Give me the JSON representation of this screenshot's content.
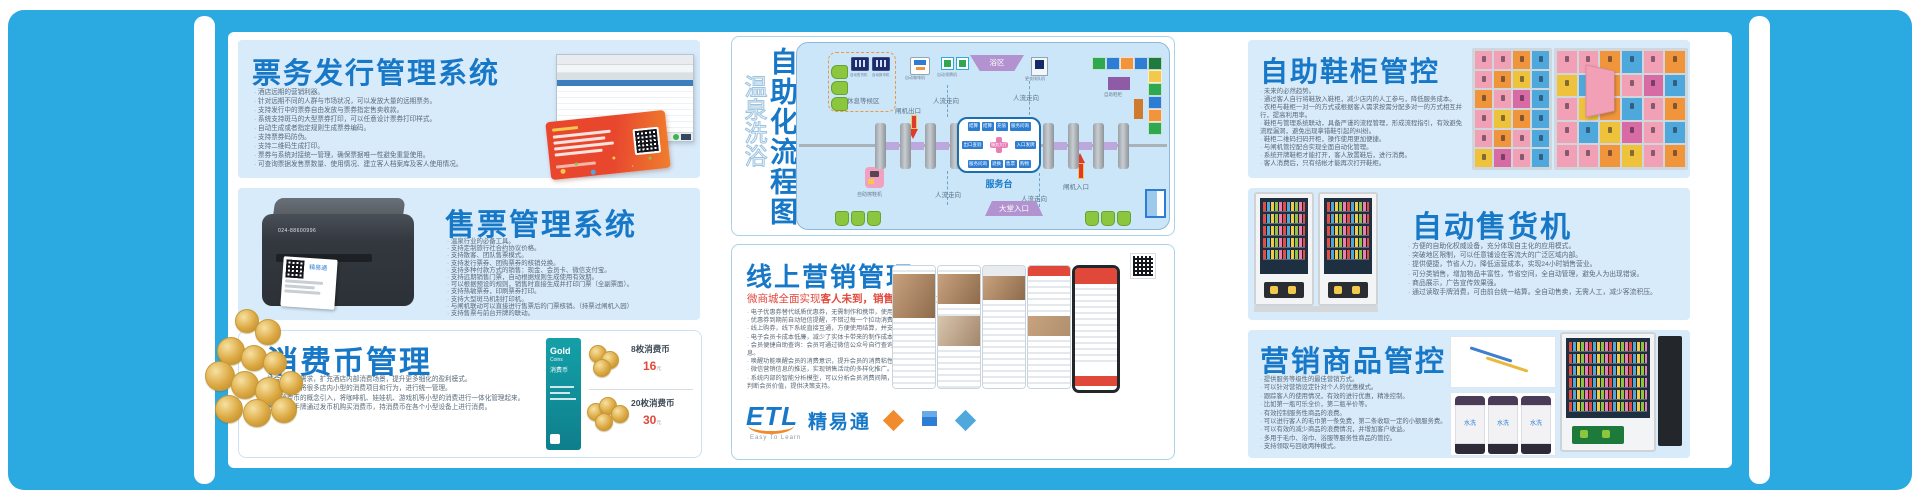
{
  "colors": {
    "accent_blue": "#2BA9E1",
    "title_blue": "#1878C8",
    "panel_blue": "#D8EBFA",
    "alert_red": "#E2483C"
  },
  "panels": {
    "ticketing": {
      "title": "票务发行管理系统",
      "bullets": [
        "酒店远期的营销利器。",
        "针对远期不同的人群与市场状况，可以发放大量的远期票务。",
        "支持发行中的票券自由发放与票券指定售卖收款。",
        "系统支持斑马的大型票券打印，可以任意设计票券打印样式。",
        "自动生成或者指定规则生成票券编码。",
        "支持票券码防伪。",
        "支持二维码生成打印。",
        "票券与系统对接统一管理，确保票据唯一性避免重复使用。",
        "可查询票据发售票数量、使用情况、建立客人档案库及客人使用情况。"
      ]
    },
    "ticket_sales": {
      "title": "售票管理系统",
      "printer_label": "024-88600996",
      "ticket_brand": "精易通",
      "bullets": [
        "温泉行业的必备工具。",
        "支持定制旅行社合约协议价格。",
        "支持散客、团队售票模式。",
        "支持发行票券、团购票券的核销兑换。",
        "支持多种付款方式的销售：现金、会员卡、微信支付宝。",
        "支持远期销售门票，自动根据规则生成使用有效期。",
        "可以根据预设的规则，销售时直接生成并打印门票（全副票面）。",
        "支持热敏票券，印刷票券打印。",
        "支持大型斑马机制打印机。",
        "与闸机联动可以直接进行售票后的门票核销。（持票过闸机入园）",
        "支持售票与前台开牌的联动。"
      ]
    },
    "coins": {
      "title": "消费币管理",
      "bullets": [
        "结合消费的需求，扩充酒店内部消费场景，提升更多细化的盈利模式。",
        "利用消费币将很多店内小型的消费项目和行为，进行统一管理。",
        "利用消费币的概念引入，将咖啡机、娃娃机、游戏机等小型的消费进行一体化管理起来。",
        "客人利用手牌通过发币机购买消费币，持消费币在各个小型设备上进行消费。"
      ],
      "card": {
        "brand": "Gold",
        "brand2": "Coins",
        "subtitle": "消费币"
      },
      "items": [
        {
          "label": "8枚消费币",
          "price": "16",
          "unit": "元"
        },
        {
          "label": "20枚消费币",
          "price": "30",
          "unit": "元"
        }
      ]
    },
    "flow": {
      "title_main": "自助化流程图",
      "title_sub": "温泉洗浴",
      "rest_area": "休息等候区",
      "machine_labels": [
        "自动售货机",
        "自动换币机",
        "自动咖啡机"
      ],
      "gate_exit": "闸机出口",
      "gate_entry": "闸机入口",
      "people_flow": "人流走向",
      "shoe_polisher": "自助擦鞋机",
      "bath_area": "浴区",
      "claim_machine": "自动领牌机",
      "queue_machine": "更衣排队机",
      "shoe_cabinet": "自助鞋柜",
      "lobby_entrance": "大堂入口",
      "service_desk": "服务台",
      "service_box": {
        "top": [
          "结算",
          "结算",
          "充值",
          "服务问询"
        ],
        "left": "出口查验",
        "center": "服务大厅",
        "right": "入口发牌",
        "bottom": [
          "服务问询",
          "退换",
          "售票",
          "购物"
        ]
      }
    },
    "online": {
      "title": "线上营销管理",
      "subtitle_lead": "微商城全面实现",
      "subtitle_strong": "客人未到，销售先行",
      "subtitle_tail": "的理念",
      "bullets": [
        "电子优惠券替代纸质优惠券，无需制作和携带，使用方便。",
        "优惠券到期前自动短信提醒，不错过每一个拉动消费的机会。",
        "线上购券，线下系统直接互通，方便使用结算，并支持核销。",
        "电子会员卡成本低廉，减少了实体卡带来的制作成本。",
        "会员便捷自助查询：会员可通过微信公众号自行查询相关信息。",
        "唤醒功能唤醒会员的消费意识，提升会员的消费粘性。",
        "微信营销信息的推送，实现销售活动的多样化推广。",
        "系统内部的智能分析模型，可以分析会员消费间隔，帮您精准判断会员价值，提供决策支持。"
      ],
      "logo": {
        "etl": "ETL",
        "brand": "精易通",
        "tagline": "Easy To Learn"
      }
    },
    "lockers": {
      "title": "自助鞋柜管控",
      "bullets": [
        "未来的必然趋势。",
        "通过客人自行将鞋放入鞋柜，减少店内的人工参与，降低服务成本。",
        "衣柜与鞋柜一对一的方式或根据客人需求按需分配多对一的方式相互并行，提高利用率。",
        "鞋柜与管理系统联动，具备严谨的流程管理，形成流程指引，有效避免流程漏洞，避免出现拿错鞋引起的纠纷。",
        "鞋柜二维码扫码开柜，操作使用更加便捷。",
        "与闸机管控配合实现全面自动化管理。",
        "系统开牌鞋柜才能打开，客人放置鞋后，进行消费。",
        "客人消费后，只有结帐才能再次打开鞋柜。"
      ]
    },
    "vending": {
      "title": "自动售货机",
      "bullets": [
        "方便的自助化权威设备，充分体现自主化的应用模式。",
        "突破地区限制，可以任意铺设在客流大的广泛区域内部。",
        "提供便捷，节省人力，降低运营成本，实现24小时销售营业。",
        "可分类销售，增加物品丰富性，节省空间，全自动管理，避免人为出现错误。",
        "商品展示，广告宣传效果强。",
        "通过读取手牌消费，可由前台统一结算。全自动售卖，无需人工，减少客流积压。"
      ]
    },
    "goods": {
      "title": "营销商品管控",
      "towel_text": "水洗",
      "bullets": [
        "提供服务等级性的最佳营销方式。",
        "可以针对营销设定针对个人的优惠模式。",
        "跟踪客人的使用情况，有效的进行优惠，精准控制。",
        "比如第一瓶可乐全价，第二瓶半价等。",
        "有效控制服务性商品的浪费。",
        "可以进行客人的毛巾第一条免费，第二条收取一定的小额服务费。",
        "可以有效的减少商品的浪费情况，并增加客户收益。",
        "多用于毛巾、浴巾、浴服等服务性商品的管控。",
        "支持领取与回收两种模式。"
      ]
    }
  }
}
